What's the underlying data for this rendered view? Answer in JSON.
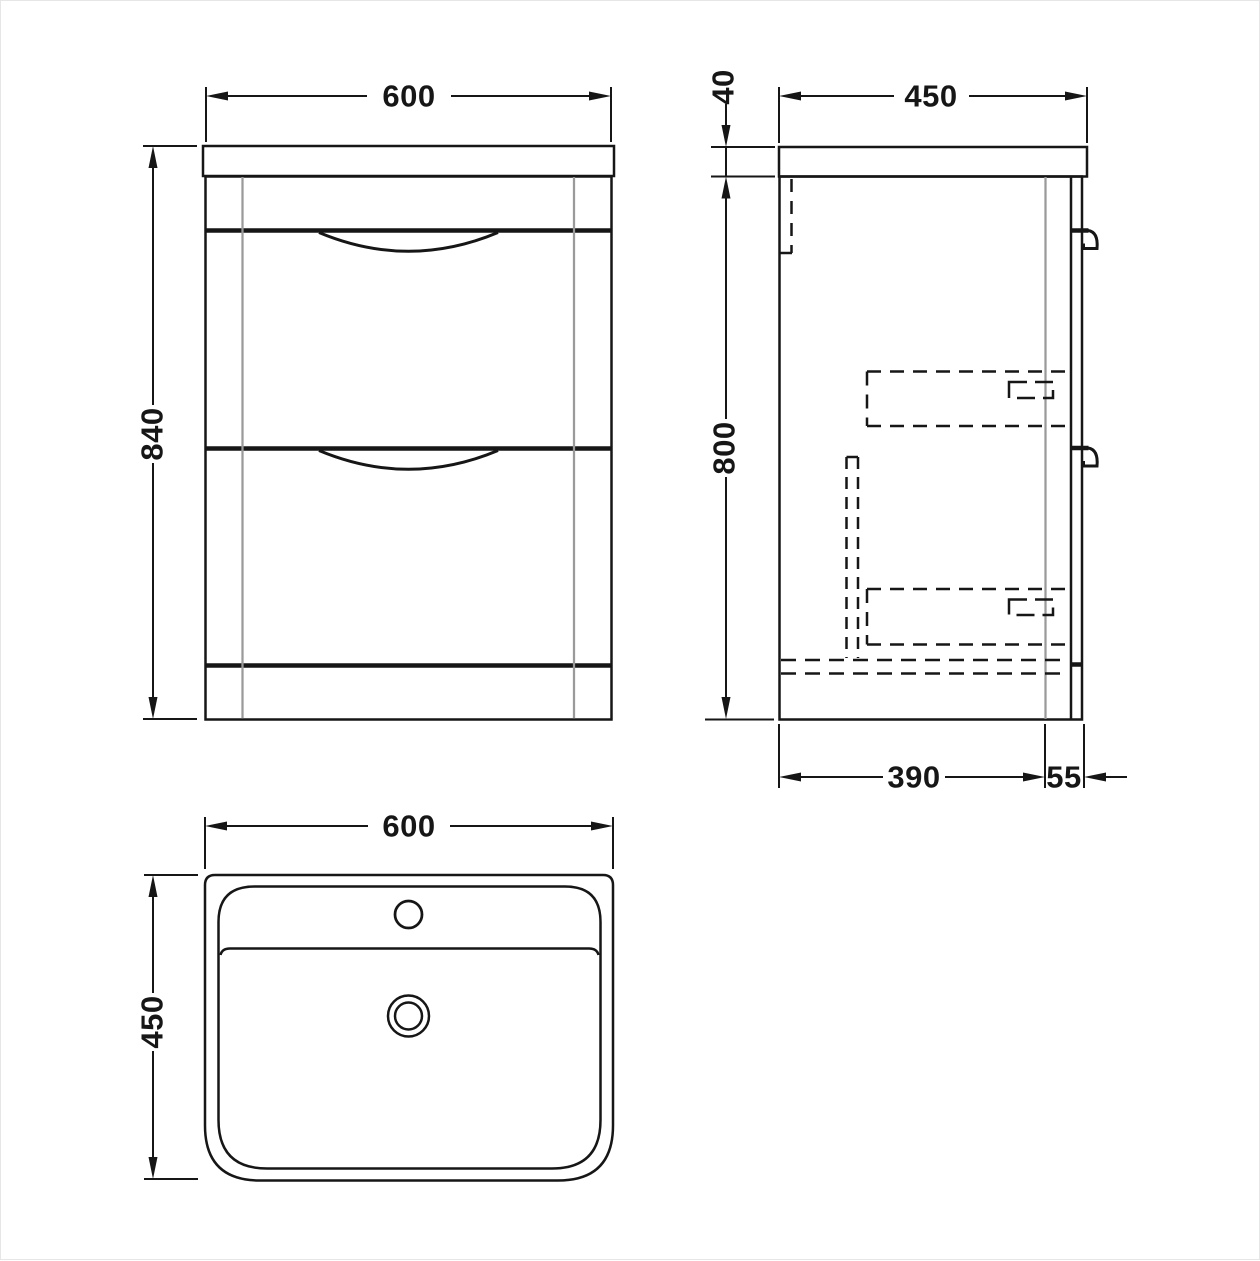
{
  "drawing": {
    "type": "bathroom-vanity-unit-technical-drawing",
    "views": {
      "front": {
        "label": "front-elevation"
      },
      "side": {
        "label": "side-elevation"
      },
      "plan": {
        "label": "basin-plan"
      }
    }
  },
  "dimensions": {
    "front": {
      "width_mm": "600",
      "height_mm": "840"
    },
    "side": {
      "depth_mm": "450",
      "worktop_thickness_mm": "40",
      "cabinet_height_mm": "800",
      "base_depth_mm": "390",
      "drawer_front_mm": "55"
    },
    "plan": {
      "width_mm": "600",
      "depth_mm": "450"
    }
  },
  "colors": {
    "line": "#161616",
    "secondary_line": "#9a9a9a",
    "background": "#ffffff"
  }
}
